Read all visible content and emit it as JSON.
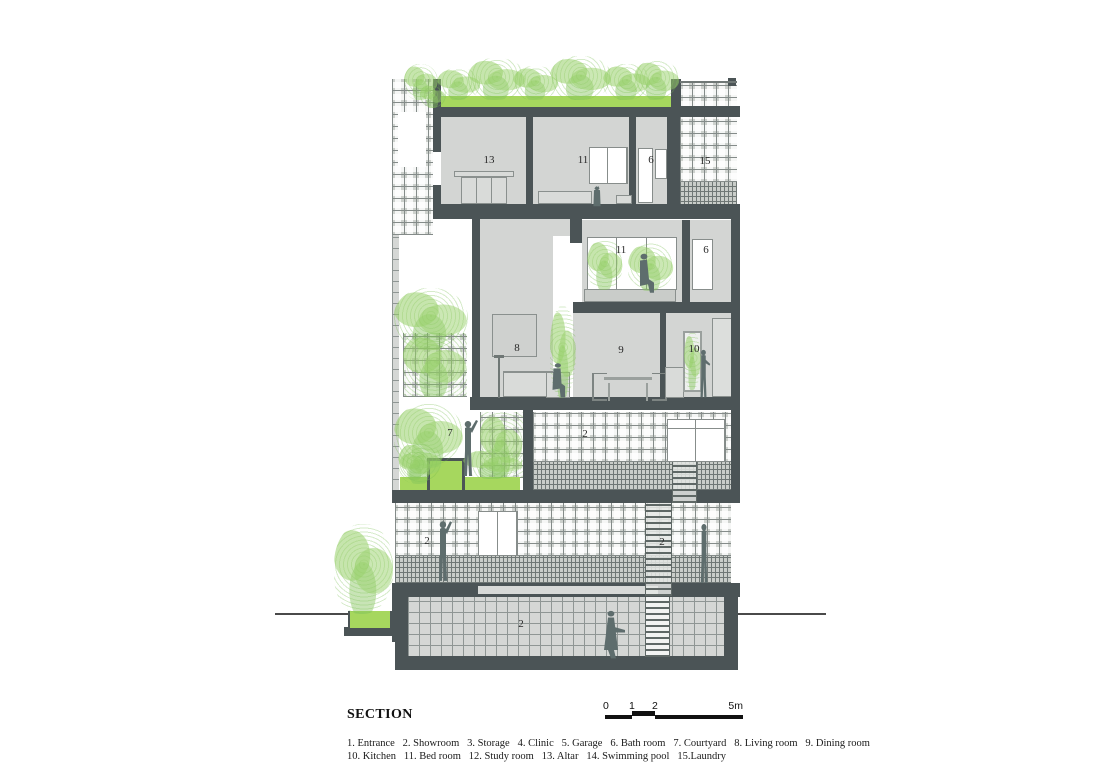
{
  "title": "SECTION",
  "scale_bar": {
    "tick_labels": [
      "0",
      "1",
      "2",
      "5m"
    ]
  },
  "legend": {
    "items": [
      "1. Entrance",
      "2. Showroom",
      "3. Storage",
      "4. Clinic",
      "5. Garage",
      "6. Bath room",
      "7. Courtyard",
      "8. Living room",
      "9. Dining room",
      "10. Kitchen",
      "11. Bed room",
      "12. Study room",
      "13. Altar",
      "14. Swimming pool",
      "15.Laundry"
    ]
  },
  "room_numbers": {
    "altar": "13",
    "bedroom_upper": "11",
    "bathroom_upper": "6",
    "laundry": "15",
    "bedroom_mid": "11",
    "bathroom_mid": "6",
    "living_room": "8",
    "dining_room": "9",
    "kitchen": "10",
    "courtyard": "7",
    "showroom_level2": "2",
    "showroom_ground_left": "2",
    "showroom_ground_right": "2",
    "showroom_basement": "2"
  },
  "colors": {
    "wall": "#4b5456",
    "room_fill": "#d3d5d3",
    "green": "#a6d75e",
    "foliage": "#8fc873",
    "figure": "#5e6d6d"
  }
}
